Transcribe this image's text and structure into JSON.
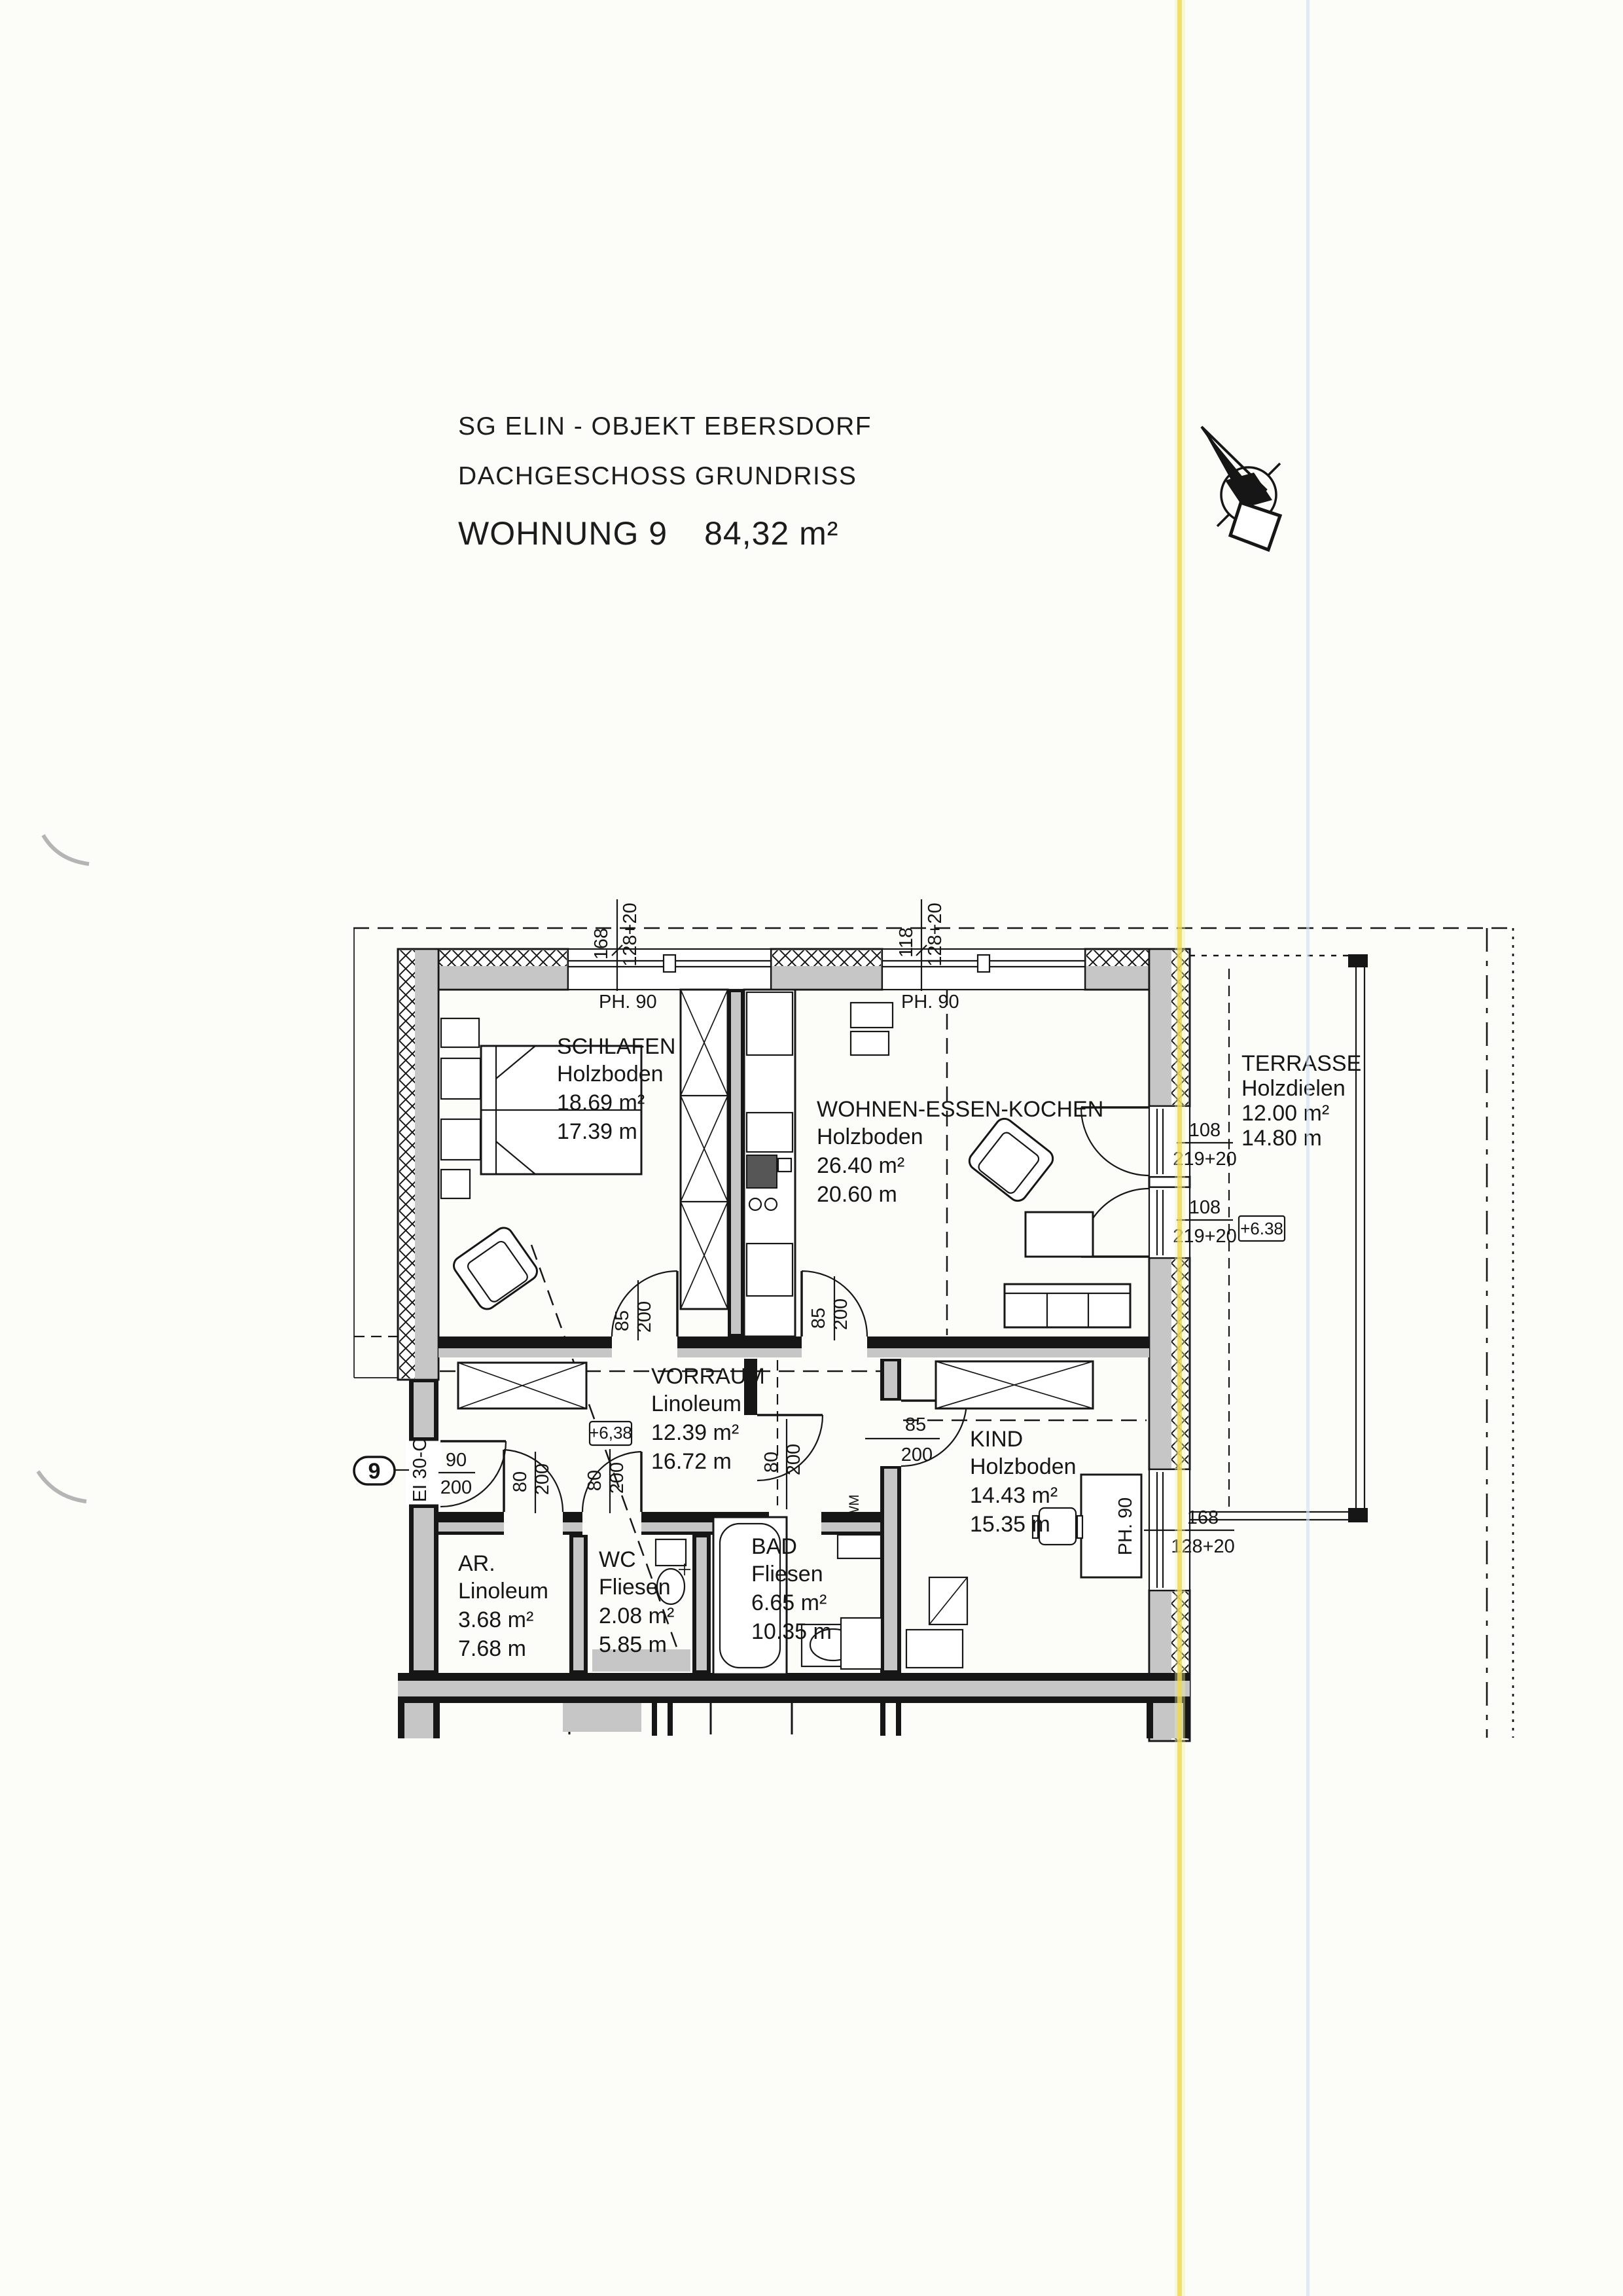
{
  "header": {
    "line1": "SG ELIN - OBJEKT EBERSDORF",
    "line2": "DACHGESCHOSS  GRUNDRISS",
    "apartment": "WOHNUNG 9",
    "total_area": "84,32 m²"
  },
  "rooms": {
    "schlafen": {
      "name": "SCHLAFEN",
      "floor": "Holzboden",
      "area": "18.69 m²",
      "perimeter": "17.39 m"
    },
    "wohnen": {
      "name": "WOHNEN-ESSEN-KOCHEN",
      "floor": "Holzboden",
      "area": "26.40 m²",
      "perimeter": "20.60 m"
    },
    "terrasse": {
      "name": "TERRASSE",
      "floor": "Holzdielen",
      "area": "12.00 m²",
      "perimeter": "14.80 m"
    },
    "vorraum": {
      "name": "VORRAUM",
      "floor": "Linoleum",
      "area": "12.39 m²",
      "perimeter": "16.72 m"
    },
    "kind": {
      "name": "KIND",
      "floor": "Holzboden",
      "area": "14.43 m²",
      "perimeter": "15.35 m"
    },
    "ar": {
      "name": "AR.",
      "floor": "Linoleum",
      "area": "3.68 m²",
      "perimeter": "7.68 m"
    },
    "wc": {
      "name": "WC",
      "floor": "Fliesen",
      "area": "2.08 m²",
      "perimeter": "5.85 m"
    },
    "bad": {
      "name": "BAD",
      "floor": "Fliesen",
      "area": "6.65 m²",
      "perimeter": "10.35 m"
    }
  },
  "windows": {
    "top_left": {
      "w": "168",
      "h": "128+20"
    },
    "top_right": {
      "w": "118",
      "h": "128+20"
    },
    "kind": {
      "w": "168",
      "h": "128+20"
    }
  },
  "parapets": {
    "top_left": "PH. 90",
    "top_right": "PH. 90",
    "kind": "PH. 90"
  },
  "terrace_doors": {
    "upper": {
      "w": "108",
      "h": "219+20"
    },
    "lower": {
      "w": "108",
      "h": "219+20"
    }
  },
  "doors": {
    "entry": {
      "w": "90",
      "h": "200"
    },
    "schlafen": {
      "w": "85",
      "h": "200"
    },
    "wohnen": {
      "w": "85",
      "h": "200"
    },
    "kind": {
      "w": "85",
      "h": "200"
    },
    "ar": {
      "w": "80",
      "h": "200"
    },
    "wc": {
      "w": "80",
      "h": "200"
    },
    "hall": {
      "w": "80",
      "h": "200"
    }
  },
  "levels": {
    "vorraum": "+6,38",
    "terrasse": "+6.38"
  },
  "entry": {
    "unit_number": "9",
    "fire_rating": "EI 30-C"
  },
  "appliances": {
    "washing_machine": "WM"
  }
}
